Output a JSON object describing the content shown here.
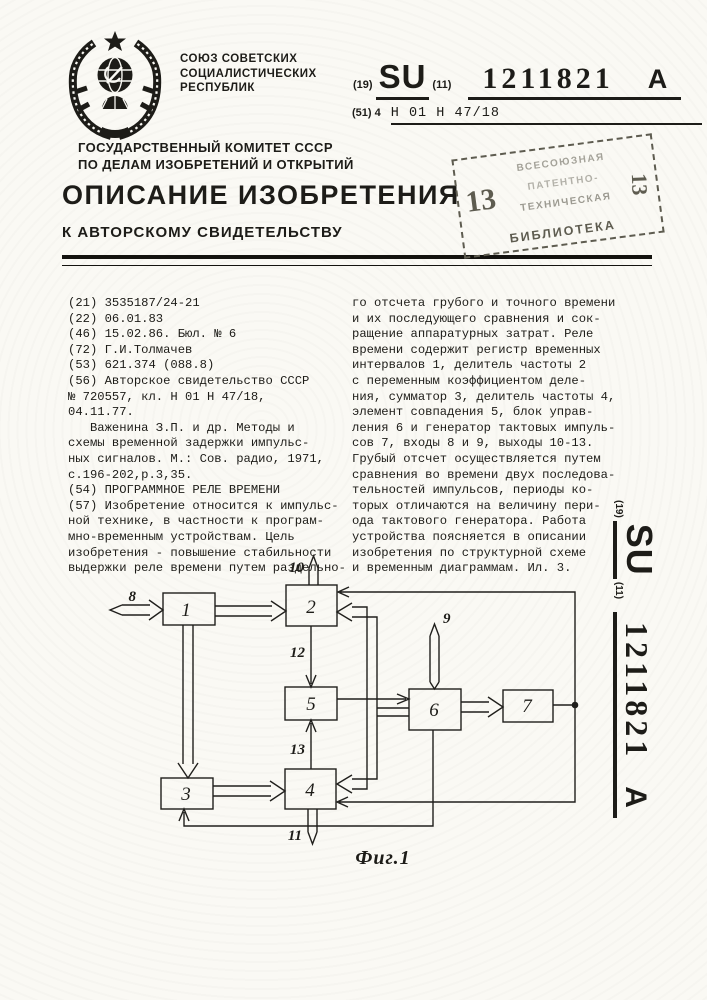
{
  "union": {
    "lines": [
      "СОЮЗ СОВЕТСКИХ",
      "СОЦИАЛИСТИЧЕСКИХ",
      "РЕСПУБЛИК"
    ]
  },
  "committee": {
    "lines": [
      "ГОСУДАРСТВЕННЫЙ КОМИТЕТ СССР",
      "ПО ДЕЛАМ ИЗОБРЕТЕНИЙ И ОТКРЫТИЙ"
    ]
  },
  "pub": {
    "code19": "(19)",
    "country": "SU",
    "code11": "(11)",
    "number": "1211821",
    "kind": "A"
  },
  "ipc": {
    "prefix": "(51) 4",
    "value": "H 01 H 47/18"
  },
  "title": {
    "main": "ОПИСАНИЕ ИЗОБРЕТЕНИЯ",
    "sub": "К АВТОРСКОМУ СВИДЕТЕЛЬСТВУ"
  },
  "stamp": {
    "left_number": "13",
    "right_number": "13",
    "line1": "ВСЕСОЮЗНАЯ",
    "line2": "ПАТЕНТНО-",
    "line3": "ТЕХНИЧЕСКАЯ",
    "bottom": "БИБЛИОТЕКА"
  },
  "left_column": [
    "(21) 3535187/24-21",
    "(22) 06.01.83",
    "(46) 15.02.86. Бюл. № 6",
    "(72) Г.И.Толмачев",
    "(53) 621.374 (088.8)",
    "(56) Авторское свидетельство СССР",
    "№ 720557, кл. H 01 H 47/18,",
    "04.11.77.",
    "   Важенина З.П. и др. Методы и",
    "схемы временной задержки импульс-",
    "ных сигналов. М.: Сов. радио, 1971,",
    "с.196-202,р.3,35.",
    "(54) ПРОГРАММНОЕ РЕЛЕ ВРЕМЕНИ",
    "(57) Изобретение относится к импульс-",
    "ной технике, в частности к програм-",
    "мно-временным устройствам. Цель",
    "изобретения - повышение стабильности",
    "выдержки реле времени путем раздельно-"
  ],
  "right_column": [
    "го отсчета грубого и точного времени",
    "и их последующего сравнения и сок-",
    "ращение аппаратурных затрат. Реле",
    "времени содержит регистр временных",
    "интервалов 1, делитель частоты 2",
    "с переменным коэффициентом деле-",
    "ния, сумматор 3, делитель частоты 4,",
    "элемент совпадения 5, блок управ-",
    "ления 6 и генератор тактовых импуль-",
    "сов 7, входы 8 и 9, выходы 10-13.",
    "Грубый отсчет осуществляется путем",
    "сравнения во времени двух последова-",
    "тельностей импульсов, периоды ко-",
    "торых отличаются на величину пери-",
    "ода тактового генератора. Работа",
    "устройства поясняется в описании",
    "изобретения по структурной схеме",
    "и временным диаграммам. Ил. 3."
  ],
  "figure": {
    "caption": "Фиг.1",
    "labels": {
      "b1": "1",
      "b2": "2",
      "b3": "3",
      "b4": "4",
      "b5": "5",
      "b6": "6",
      "b7": "7",
      "p8": "8",
      "p9": "9",
      "p10": "10",
      "p11": "11",
      "p12": "12",
      "p13": "13"
    }
  }
}
